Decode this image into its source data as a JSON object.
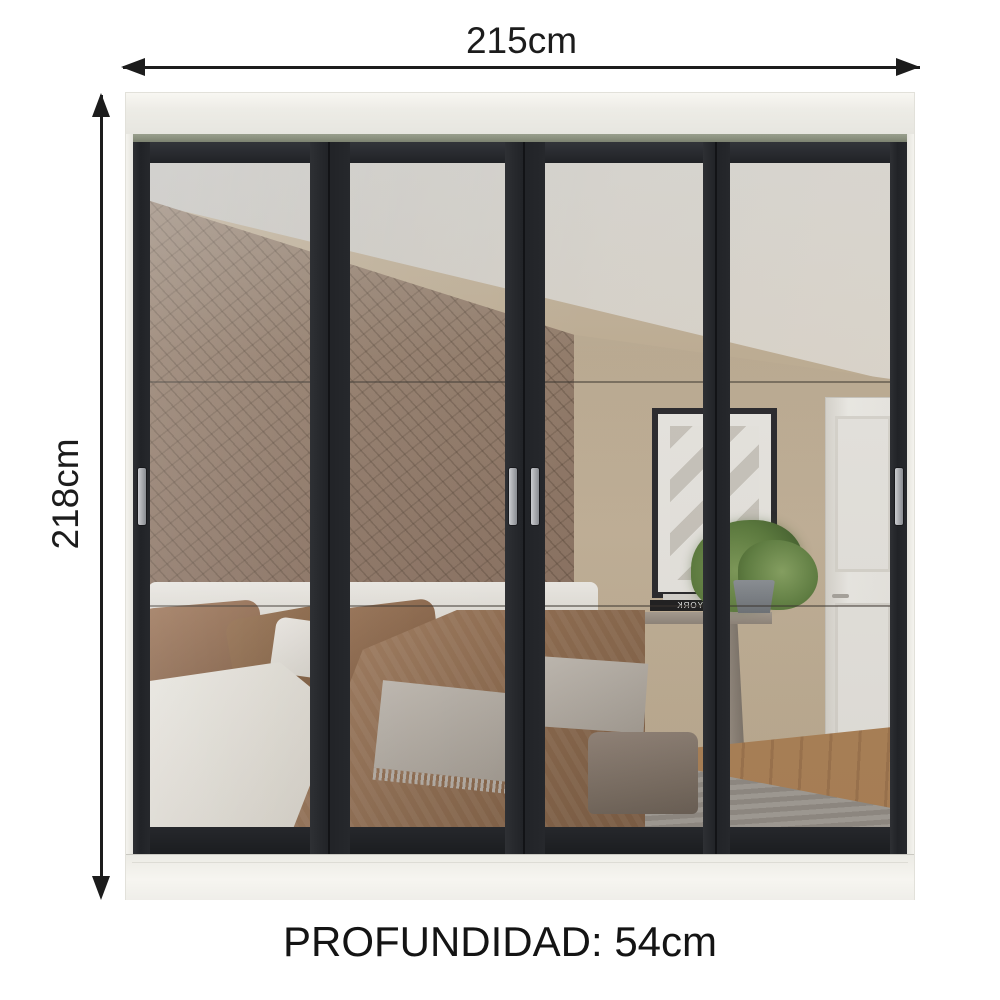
{
  "annotations": {
    "width_label": "215cm",
    "height_label": "218cm",
    "depth_label": "PROFUNDIDAD: 54cm"
  },
  "wardrobe": {
    "door_count": 4,
    "handle_count": 4,
    "reflection": {
      "book_spine_text": "NEW YORK"
    }
  },
  "palette": {
    "dimension_ink": "#1c1c1c",
    "body_white": "#f0efe9",
    "door_frame_black": "#26282c",
    "track_olive": "#8d9181",
    "mirror_wall_beige": "#bcab90",
    "panel_wall_brown": "#8f7a67",
    "bedding_brown": "#9c7758",
    "sheet_white": "#f1efe9",
    "plant_green": "#5a7a3c",
    "floor_wood": "#a87c52"
  }
}
